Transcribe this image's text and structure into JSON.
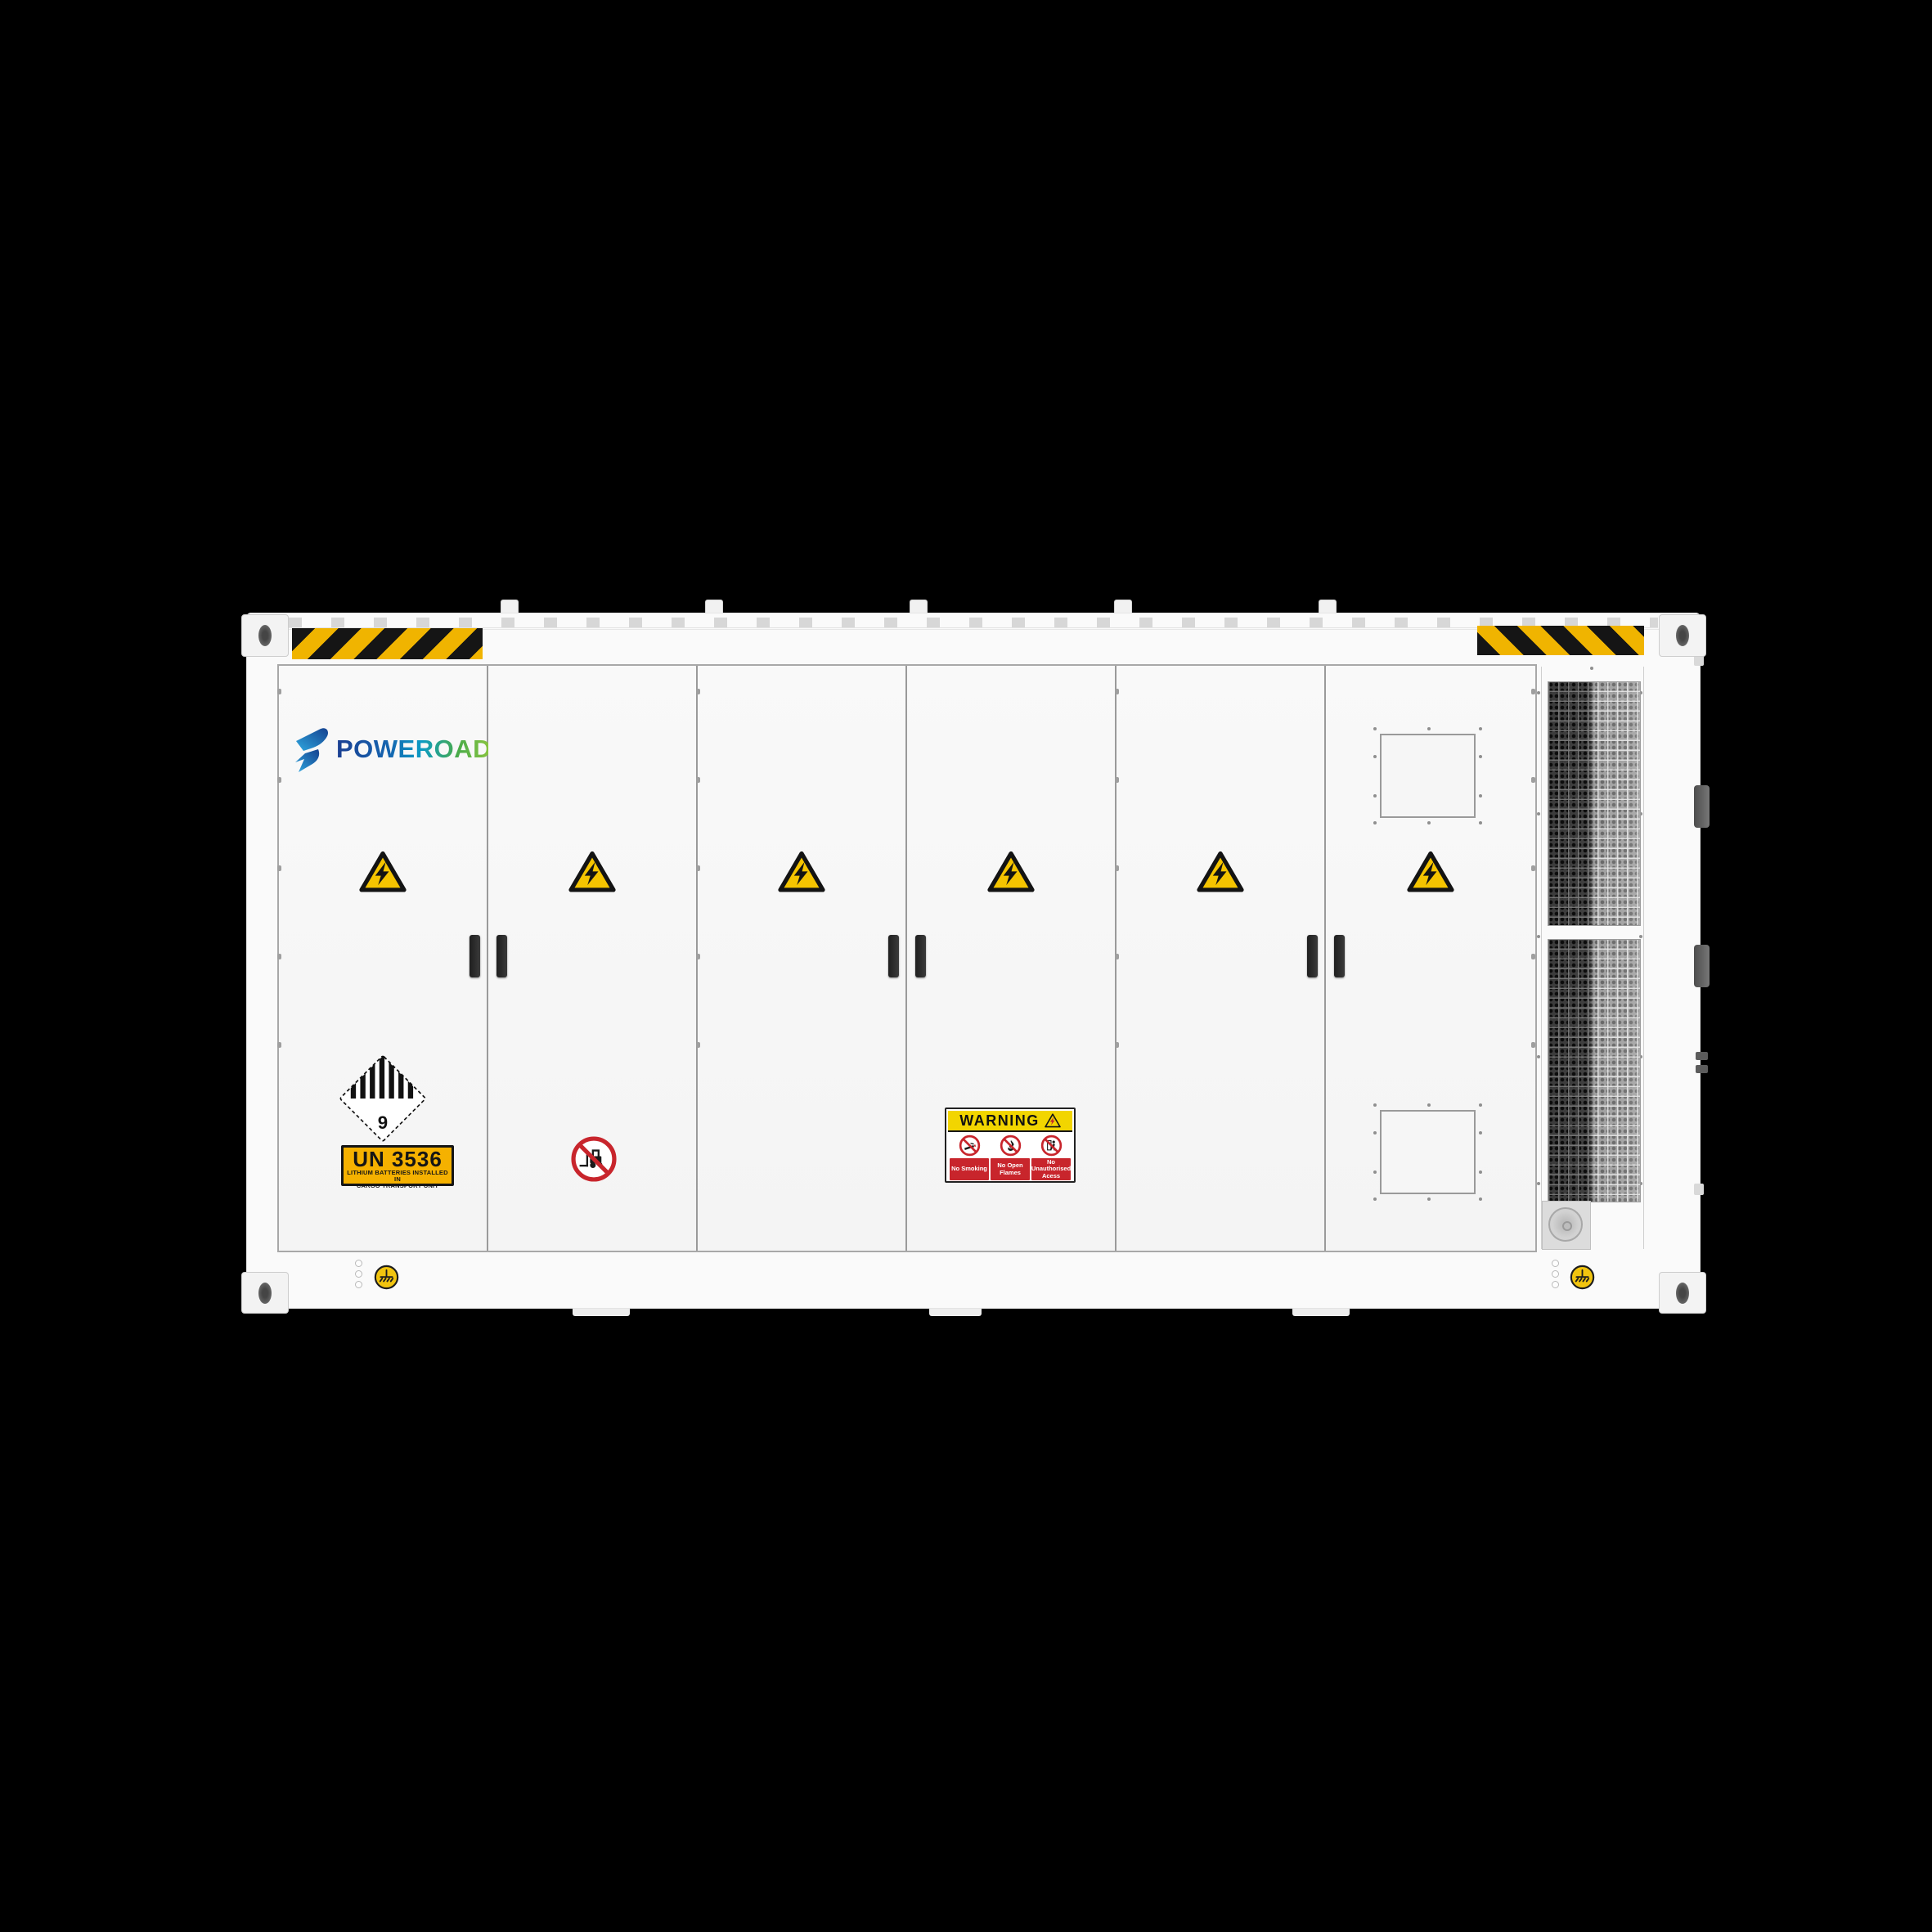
{
  "brand": {
    "name": "POWEROAD"
  },
  "placards": {
    "class9": {
      "number": "9"
    },
    "un3536": {
      "code": "UN 3536",
      "line1": "LITHIUM BATTERIES INSTALLED IN",
      "line2": "CARGO TRANSPORT UNIT"
    },
    "warning": {
      "title": "WARNING",
      "items": [
        "No Smoking",
        "No Open Flames",
        "No Unauthorised Acess"
      ]
    }
  },
  "icons": {
    "high_voltage": "yellow-triangle-lightning",
    "no_forklift": "forklift-prohibition",
    "no_smoking": "cigarette-prohibition",
    "no_open_flames": "flame-prohibition",
    "no_unauthorised_access": "person-prohibition",
    "grounding_point": "earth-ground-symbol",
    "class9_placard": "striped-diamond-class9"
  },
  "colors": {
    "background": "#000000",
    "body_white": "#fafafa",
    "hazard_yellow": "#f0b400",
    "triangle_yellow": "#f5c400",
    "prohibition_red": "#c8252c",
    "un_label_amber": "#f5b100",
    "warning_header_yellow": "#f2d500",
    "ground_yellow": "#f1c40f",
    "brand_blue": "#1b3f92",
    "brand_green": "#8dc63f"
  }
}
